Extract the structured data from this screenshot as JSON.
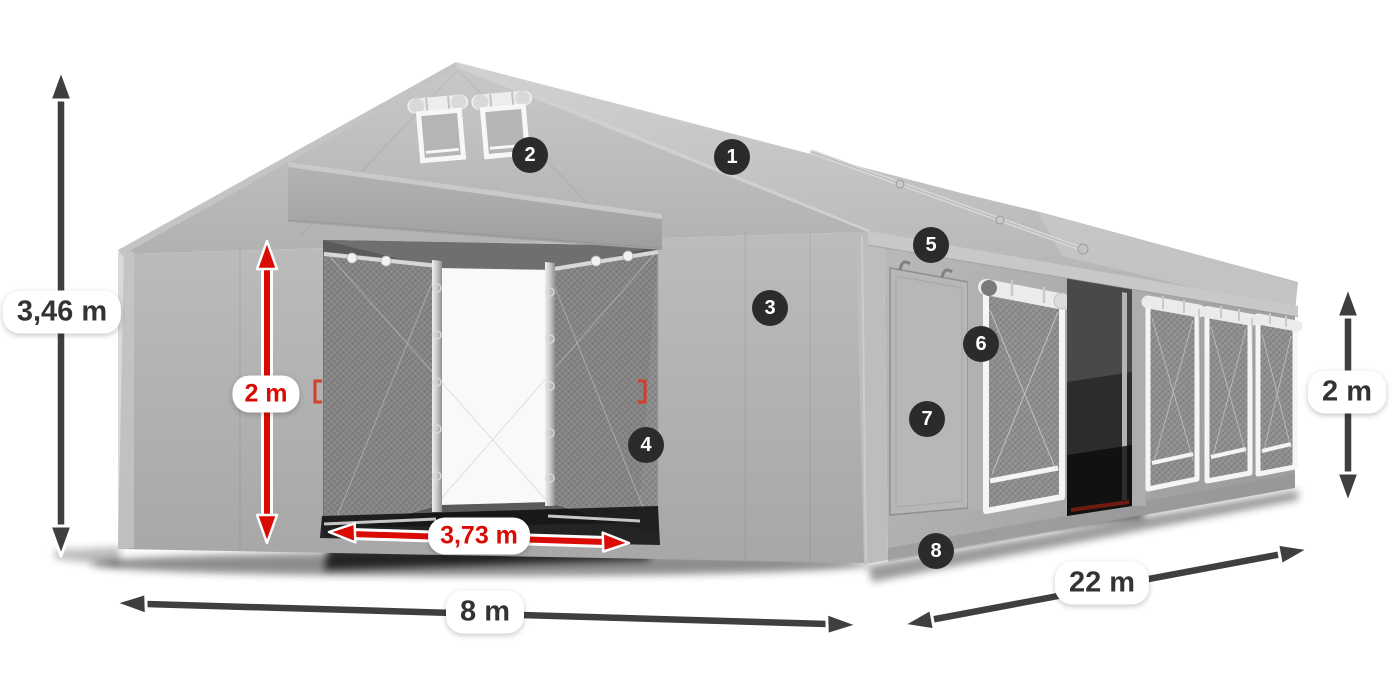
{
  "diagram": {
    "subject": "Marquee storage tent with numbered features and dimension arrows",
    "badges": [
      {
        "label": "1"
      },
      {
        "label": "2"
      },
      {
        "label": "3"
      },
      {
        "label": "4"
      },
      {
        "label": "5"
      },
      {
        "label": "6"
      },
      {
        "label": "7"
      },
      {
        "label": "8"
      }
    ],
    "dimensions": {
      "total_height": {
        "value": "3,46 m"
      },
      "entrance_height": {
        "value": "2 m"
      },
      "entrance_width": {
        "value": "3,73 m"
      },
      "front_width": {
        "value": "8 m"
      },
      "side_length": {
        "value": "22 m"
      },
      "side_height": {
        "value": "2 m"
      }
    },
    "colors": {
      "red_accent": "#d90b04",
      "arrow_gray": "#3f3f3f",
      "badge_background": "#2b2b2b",
      "badge_text": "#ffffff",
      "label_background": "#ffffff",
      "label_text": "#333333",
      "background": "#ffffff",
      "tent_light": "#c9c9c9",
      "tent_mid": "#b3b3b3",
      "tent_dark": "#9d9d9d"
    }
  }
}
